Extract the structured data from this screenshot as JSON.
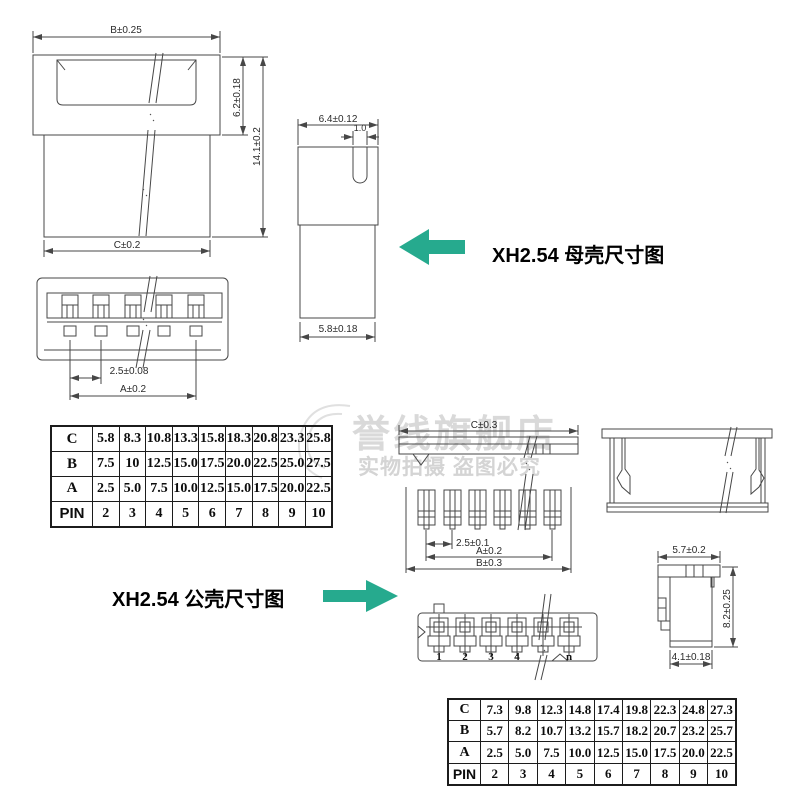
{
  "female_section": {
    "title": "XH2.54 母壳尺寸图",
    "front_view": {
      "width_top": "B±0.25",
      "height_upper": "6.2±0.18",
      "height_total": "14.1±0.2",
      "width_bottom": "C±0.2"
    },
    "side_view": {
      "width_top": "6.4±0.12",
      "slot_width": "1.0",
      "width_bottom": "5.8±0.18"
    },
    "pin_view": {
      "pitch": "2.5±0.08",
      "span": "A±0.2"
    },
    "table": {
      "rows": [
        {
          "header": "C",
          "values": [
            "5.8",
            "8.3",
            "10.8",
            "13.3",
            "15.8",
            "18.3",
            "20.8",
            "23.3",
            "25.8"
          ]
        },
        {
          "header": "B",
          "values": [
            "7.5",
            "10",
            "12.5",
            "15.0",
            "17.5",
            "20.0",
            "22.5",
            "25.0",
            "27.5"
          ]
        },
        {
          "header": "A",
          "values": [
            "2.5",
            "5.0",
            "7.5",
            "10.0",
            "12.5",
            "15.0",
            "17.5",
            "20.0",
            "22.5"
          ]
        },
        {
          "header": "PIN",
          "values": [
            "2",
            "3",
            "4",
            "5",
            "6",
            "7",
            "8",
            "9",
            "10"
          ]
        }
      ]
    }
  },
  "male_section": {
    "title": "XH2.54 公壳尺寸图",
    "top_view": {
      "width": "C±0.3"
    },
    "pin_view": {
      "pitch": "2.5±0.1",
      "span": "A±0.2",
      "overall": "B±0.3"
    },
    "bottom_view": {
      "pin_labels": [
        "1",
        "2",
        "3",
        "4",
        "n"
      ]
    },
    "side_view": {
      "width_top": "5.7±0.2",
      "height": "8.2±0.25",
      "width_bottom": "4.1±0.18"
    },
    "table": {
      "rows": [
        {
          "header": "C",
          "values": [
            "7.3",
            "9.8",
            "12.3",
            "14.8",
            "17.4",
            "19.8",
            "22.3",
            "24.8",
            "27.3"
          ]
        },
        {
          "header": "B",
          "values": [
            "5.7",
            "8.2",
            "10.7",
            "13.2",
            "15.7",
            "18.2",
            "20.7",
            "23.2",
            "25.7"
          ]
        },
        {
          "header": "A",
          "values": [
            "2.5",
            "5.0",
            "7.5",
            "10.0",
            "12.5",
            "15.0",
            "17.5",
            "20.0",
            "22.5"
          ]
        },
        {
          "header": "PIN",
          "values": [
            "2",
            "3",
            "4",
            "5",
            "6",
            "7",
            "8",
            "9",
            "10"
          ]
        }
      ]
    }
  },
  "watermark": {
    "brand": "誉线旗舰店",
    "notice": "实物拍摄 盗图必究"
  },
  "colors": {
    "arrow": "#26aa8e",
    "line": "#474747",
    "watermark": "#d9d9d9"
  }
}
